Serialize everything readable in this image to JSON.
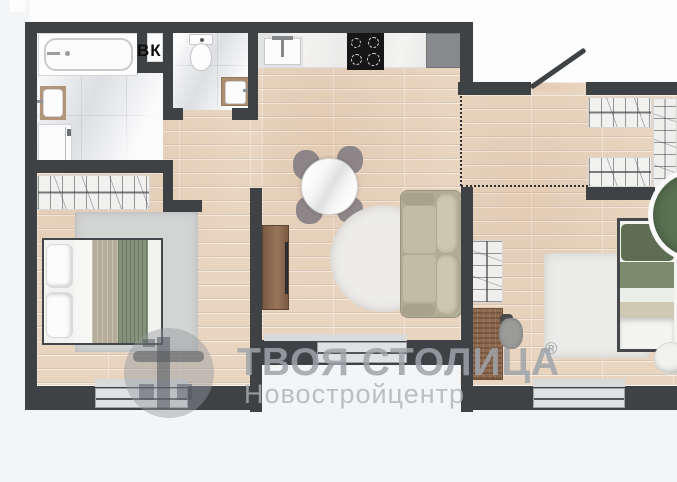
{
  "page": {
    "background": "#f4f5f7"
  },
  "plan": {
    "type": "apartment-floor-plan",
    "label_vk": "ВК",
    "watermark": {
      "brand": "ТВОЯ СТОЛИЦА",
      "registered": "®",
      "subtitle": "Новостройцентр"
    },
    "colors": {
      "wall": "#3f4245",
      "wood_floor": "#e8d4bf",
      "tile_floor": "#eaebee",
      "counter": "#f4f3f1",
      "cooktop": "#161616",
      "fridge": "#87898c",
      "sofa": "#b3ac95",
      "bed_blanket_green": "#84947c",
      "bed2_green": "#6d7f5e",
      "plant_green": "#5c7152",
      "rug_gray": "#d3d4d4",
      "rug_white": "#edecea",
      "wood_furniture": "#8a6a52",
      "window_glass": "#e0e1e3",
      "watermark_gray": "#a5aaaf",
      "dashed_line": "#2e3133"
    }
  }
}
